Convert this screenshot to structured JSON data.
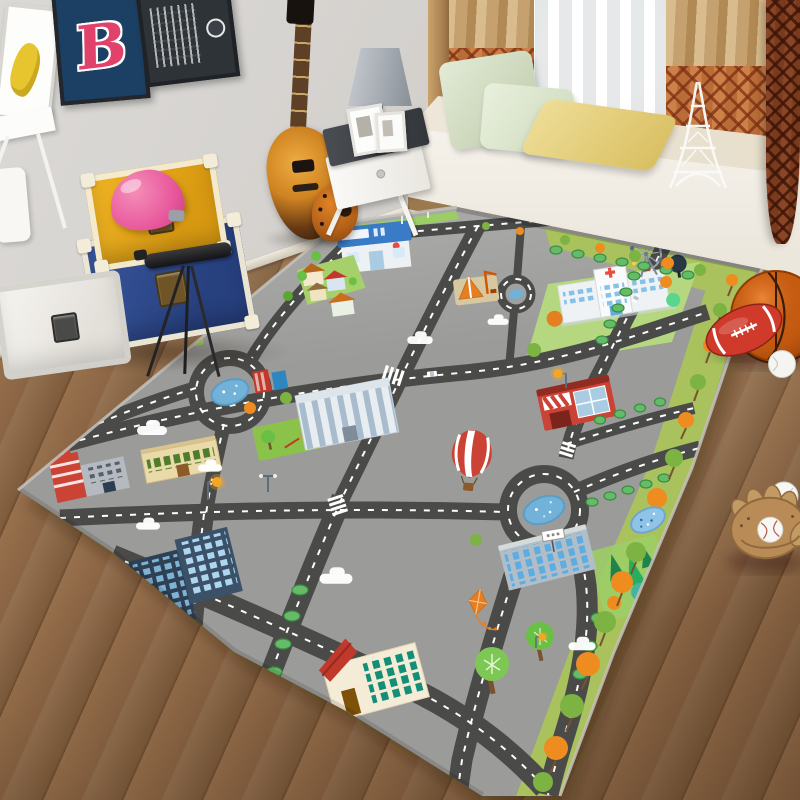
{
  "scene": {
    "description": "Kids bedroom with a city-traffic play mat rug, posters, guitar, trunks, telescope, window seat and sports gear",
    "wall": {
      "color": "#d7d5d2"
    },
    "floor": {
      "plank_color": "#8a6444",
      "seam_color": "#6b4a2f"
    },
    "posters": {
      "letter_poster": {
        "letter": "B",
        "bg": "#1c4063",
        "letter_color": "#e0426b"
      },
      "art_poster": {
        "bg": "#fdfdfb",
        "accent": "#e6c52f"
      },
      "soundwave_poster": {
        "bg": "#2e3338",
        "accent": "#ffffff"
      }
    },
    "guitar": {
      "style": "sunburst electric",
      "body_color": "#c97c1e",
      "neck_color": "#5d4026"
    },
    "side_table": {
      "frame_color": "#f7f6f3",
      "top_color": "#43474b"
    },
    "lamp": {
      "shade_color": "#9aa1a8",
      "base_pattern": "black-white harlequin"
    },
    "window_seat": {
      "bench_color": "#f6f3ec",
      "pillow_green": "#cfe0c3",
      "pillow_yellow": "#e5d17c",
      "decor": "eiffel-tower-figurine",
      "decor_color": "#f8f8f6"
    },
    "curtains": {
      "tan": "#c8a271",
      "pattern_rust": "#a34f28",
      "sheer": "#f0f2f3"
    },
    "trunks": {
      "yellow": "#e8a91c",
      "blue": "#2e4a8f",
      "white": "#f4f2ee",
      "trim": "#f3ecd8",
      "toy_helmet_pink": "#e8559b"
    },
    "telescope": {
      "color": "#1c1c1e"
    },
    "sports": {
      "basketball": "#c55a11",
      "rugby_ball": "#c0392b",
      "baseball": "#f5f5f2",
      "glove": "#b98b57"
    },
    "rug": {
      "base": "#9b9b99",
      "road": "#4a4a48",
      "road_line": "#fdfdfb",
      "grass": "#8bc34a",
      "lawn_light": "#b5d77f",
      "border_grass": "#a9c25d",
      "pond": "#72b1d8",
      "tree_green": "#7cb342",
      "tree_orange": "#ef8c1f",
      "features": [
        "roads",
        "roundabouts",
        "supermarket",
        "hospital",
        "fire-station",
        "factory",
        "school",
        "skyscrapers",
        "houses",
        "construction-site",
        "ferris-wheel",
        "hot-air-balloon",
        "kite",
        "street-lamps",
        "clouds",
        "zebra-crossings",
        "tree-lined-border",
        "ponds"
      ]
    }
  }
}
